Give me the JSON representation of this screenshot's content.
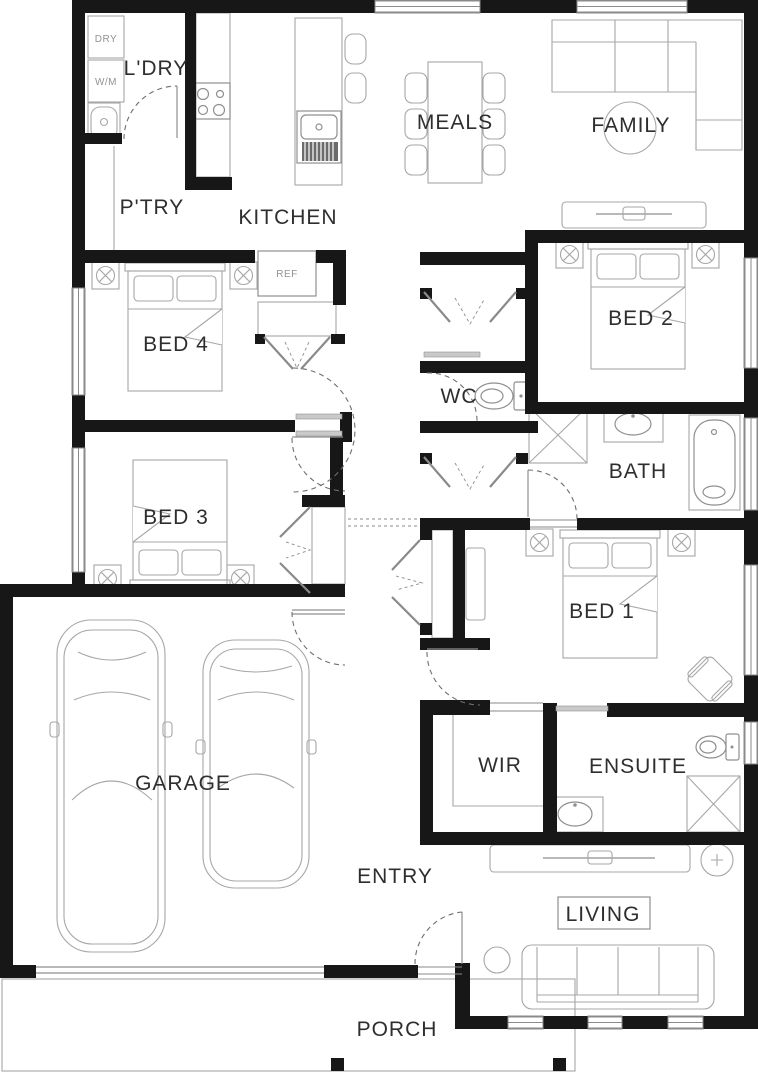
{
  "plan": {
    "title": "house-floor-plan",
    "rooms": {
      "laundry": "L'DRY",
      "pantry": "P'TRY",
      "kitchen": "KITCHEN",
      "meals": "MEALS",
      "family": "FAMILY",
      "bed4": "BED 4",
      "bed2": "BED 2",
      "wc": "WC",
      "bath": "BATH",
      "bed3": "BED 3",
      "bed1": "BED 1",
      "garage": "GARAGE",
      "wir": "WIR",
      "ensuite": "ENSUITE",
      "entry": "ENTRY",
      "living": "LIVING",
      "porch": "PORCH"
    },
    "appliances": {
      "dryer": "DRY",
      "washer": "W/M",
      "fridge": "REF"
    },
    "colors": {
      "wall": "#171717",
      "furniture_line": "#a7a7a7",
      "label": "#2e2e2e",
      "small_label": "#929292",
      "background": "#ffffff"
    }
  }
}
